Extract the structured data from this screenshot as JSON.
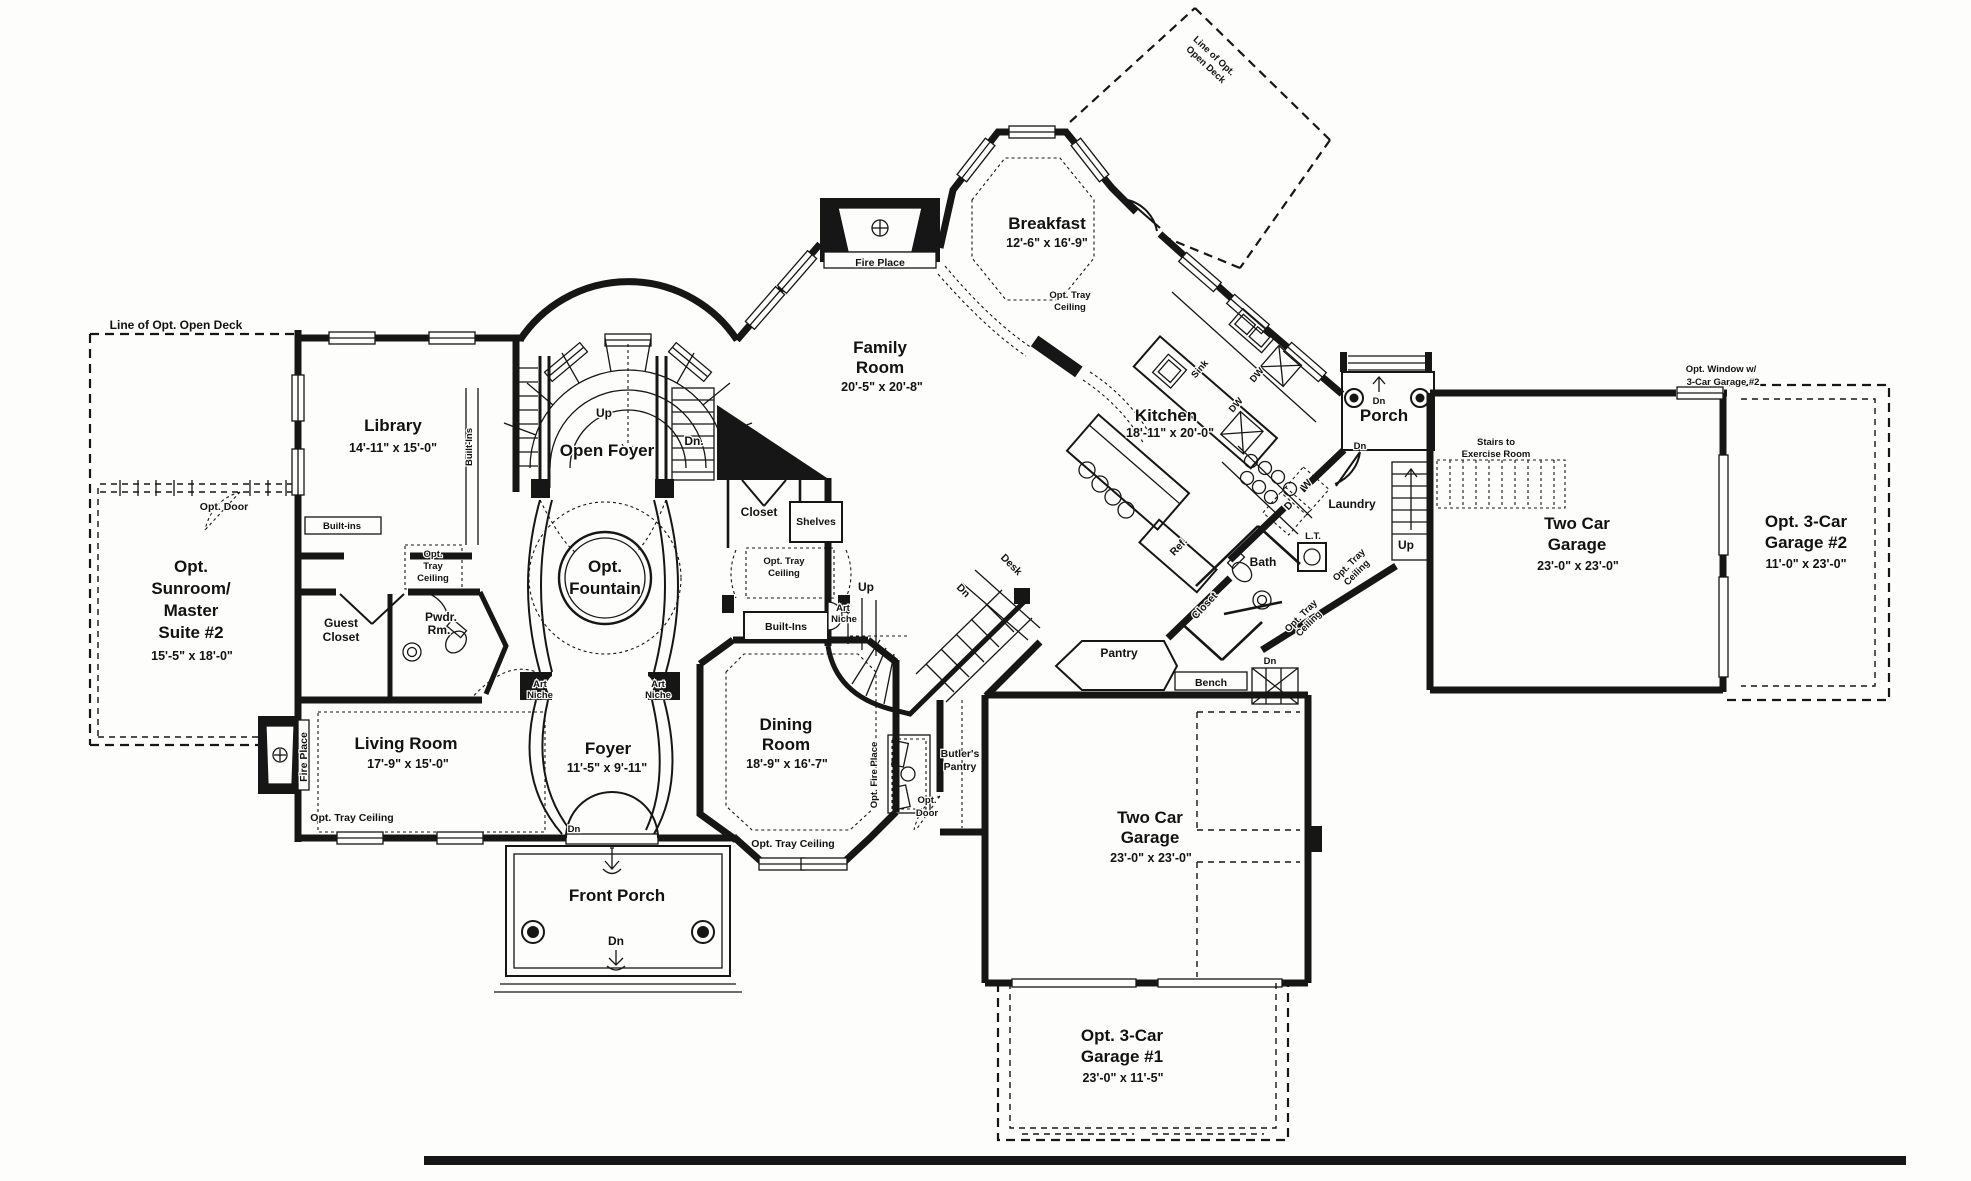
{
  "rooms": {
    "library": {
      "name": "Library",
      "dims": "14'-11\" x 15'-0\""
    },
    "sunroom": {
      "l1": "Opt.",
      "l2": "Sunroom/",
      "l3": "Master",
      "l4": "Suite #2",
      "dims": "15'-5\" x 18'-0\""
    },
    "open_foyer": {
      "name": "Open Foyer"
    },
    "fountain": {
      "l1": "Opt.",
      "l2": "Fountain"
    },
    "family_room": {
      "l1": "Family",
      "l2": "Room",
      "dims": "20'-5\" x 20'-8\""
    },
    "breakfast": {
      "name": "Breakfast",
      "dims": "12'-6\" x 16'-9\""
    },
    "kitchen": {
      "name": "Kitchen",
      "dims": "18'-11\" x 20'-0\""
    },
    "porch": {
      "name": "Porch"
    },
    "garage_right": {
      "l1": "Two Car",
      "l2": "Garage",
      "dims": "23'-0\" x 23'-0\""
    },
    "garage_opt2": {
      "l1": "Opt. 3-Car",
      "l2": "Garage #2",
      "dims": "11'-0\" x 23'-0\""
    },
    "living_room": {
      "name": "Living Room",
      "dims": "17'-9\" x 15'-0\""
    },
    "foyer": {
      "name": "Foyer",
      "dims": "11'-5\" x 9'-11\""
    },
    "dining_room": {
      "l1": "Dining",
      "l2": "Room",
      "dims": "18'-9\" x 16'-7\""
    },
    "front_porch": {
      "name": "Front Porch"
    },
    "garage_bottom": {
      "l1": "Two Car",
      "l2": "Garage",
      "dims": "23'-0\" x 23'-0\""
    },
    "garage_opt1": {
      "l1": "Opt. 3-Car",
      "l2": "Garage #1",
      "dims": "23'-0\" x 11'-5\""
    },
    "butlers_pantry": {
      "l1": "Butler's",
      "l2": "Pantry"
    },
    "pantry": {
      "name": "Pantry"
    },
    "laundry": {
      "name": "Laundry"
    },
    "bath": {
      "name": "Bath"
    },
    "guest_closet": {
      "l1": "Guest",
      "l2": "Closet"
    },
    "powder_room": {
      "l1": "Pwdr.",
      "l2": "Rm."
    },
    "hall_closet": {
      "name": "Closet"
    },
    "bath_closet": {
      "name": "Closet"
    }
  },
  "annotations": {
    "deck_line_left": "Line of Opt. Open Deck",
    "deck_line_right_1": "Line of Opt.",
    "deck_line_right_2": "Open Deck",
    "opt_door_sunroom": "Opt. Door",
    "opt_door_butler_1": "Opt.",
    "opt_door_butler_2": "Door",
    "built_ins_library": "Built-ins",
    "built_ins_foyer": "Built-Ins",
    "built_ins_dining": "Built-Ins",
    "shelves": "Shelves",
    "tray_vestibule_1": "Opt.",
    "tray_vestibule_2": "Tray",
    "tray_vestibule_3": "Ceiling",
    "tray_hall_1": "Opt. Tray",
    "tray_hall_2": "Ceiling",
    "tray_breakfast_1": "Opt. Tray",
    "tray_breakfast_2": "Ceiling",
    "tray_dining": "Opt. Tray Ceiling",
    "tray_living": "Opt. Tray Ceiling",
    "tray_bath1_1": "Opt. Tray",
    "tray_bath1_2": "Ceiling",
    "tray_bath2_1": "Opt. Tray",
    "tray_bath2_2": "Ceiling",
    "art_1": "Art",
    "art_2": "Niche",
    "fire_place_family": "Fire Place",
    "fire_place_living": "Fire Place",
    "opt_fire_place": "Opt. Fire Place",
    "stairs_ex_1": "Stairs to",
    "stairs_ex_2": "Exercise Room",
    "opt_window_1": "Opt. Window w/",
    "opt_window_2": "3-Car Garage #2",
    "bench": "Bench",
    "desk": "Desk",
    "ref": "Ref.",
    "sink": "Sink",
    "dw": "DW",
    "lt": "L.T.",
    "washer": "W",
    "dryer": "D",
    "up": "Up",
    "dn": "Dn",
    "dn_period": "Dn."
  }
}
